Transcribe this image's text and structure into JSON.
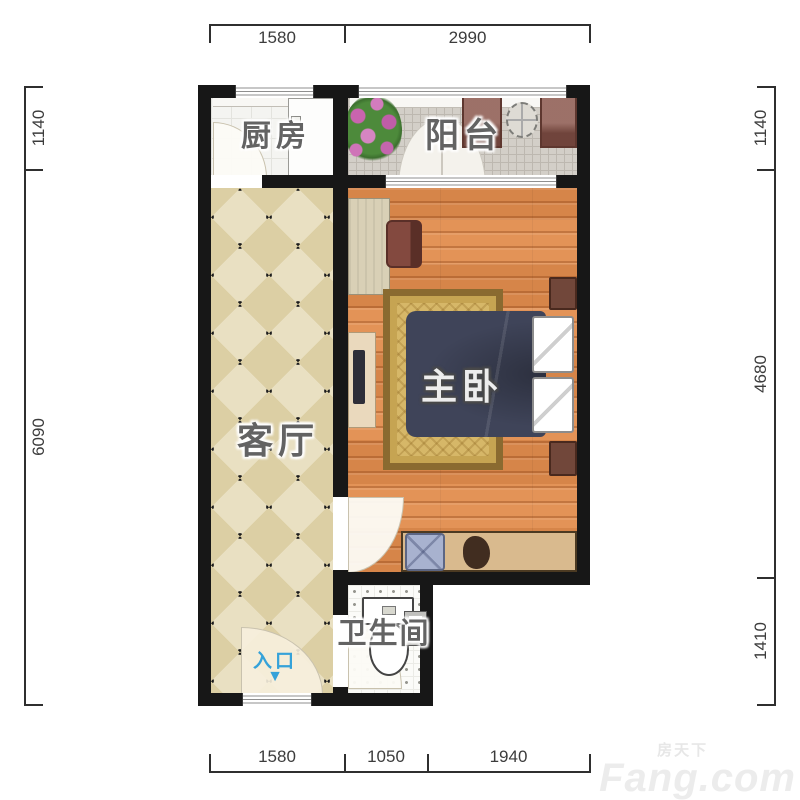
{
  "plan": {
    "rooms": {
      "kitchen": {
        "label": "厨房"
      },
      "balcony": {
        "label": "阳台"
      },
      "living": {
        "label": "客厅"
      },
      "bedroom": {
        "label": "主卧"
      },
      "bathroom": {
        "label": "卫生间"
      }
    },
    "entrance": {
      "label": "入口",
      "arrow": "▼"
    }
  },
  "dimensions": {
    "top": [
      "1580",
      "2990"
    ],
    "bottom": [
      "1580",
      "1050",
      "1940"
    ],
    "left": [
      "1140",
      "6090"
    ],
    "right": [
      "1140",
      "4680",
      "1410"
    ]
  },
  "watermark": {
    "cn": "房天下",
    "brand": "Fang.com"
  },
  "colors": {
    "wall": "#171717",
    "wood_floor": "#e18c4d",
    "living_tile": "#e9e0c2",
    "balcony_tile": "#d3cfc8",
    "bathroom_tile": "#fbfbf8",
    "rug_gold": "#c6a452",
    "bed_navy": "#3f4459",
    "entrance_blue": "#35a2d9"
  }
}
